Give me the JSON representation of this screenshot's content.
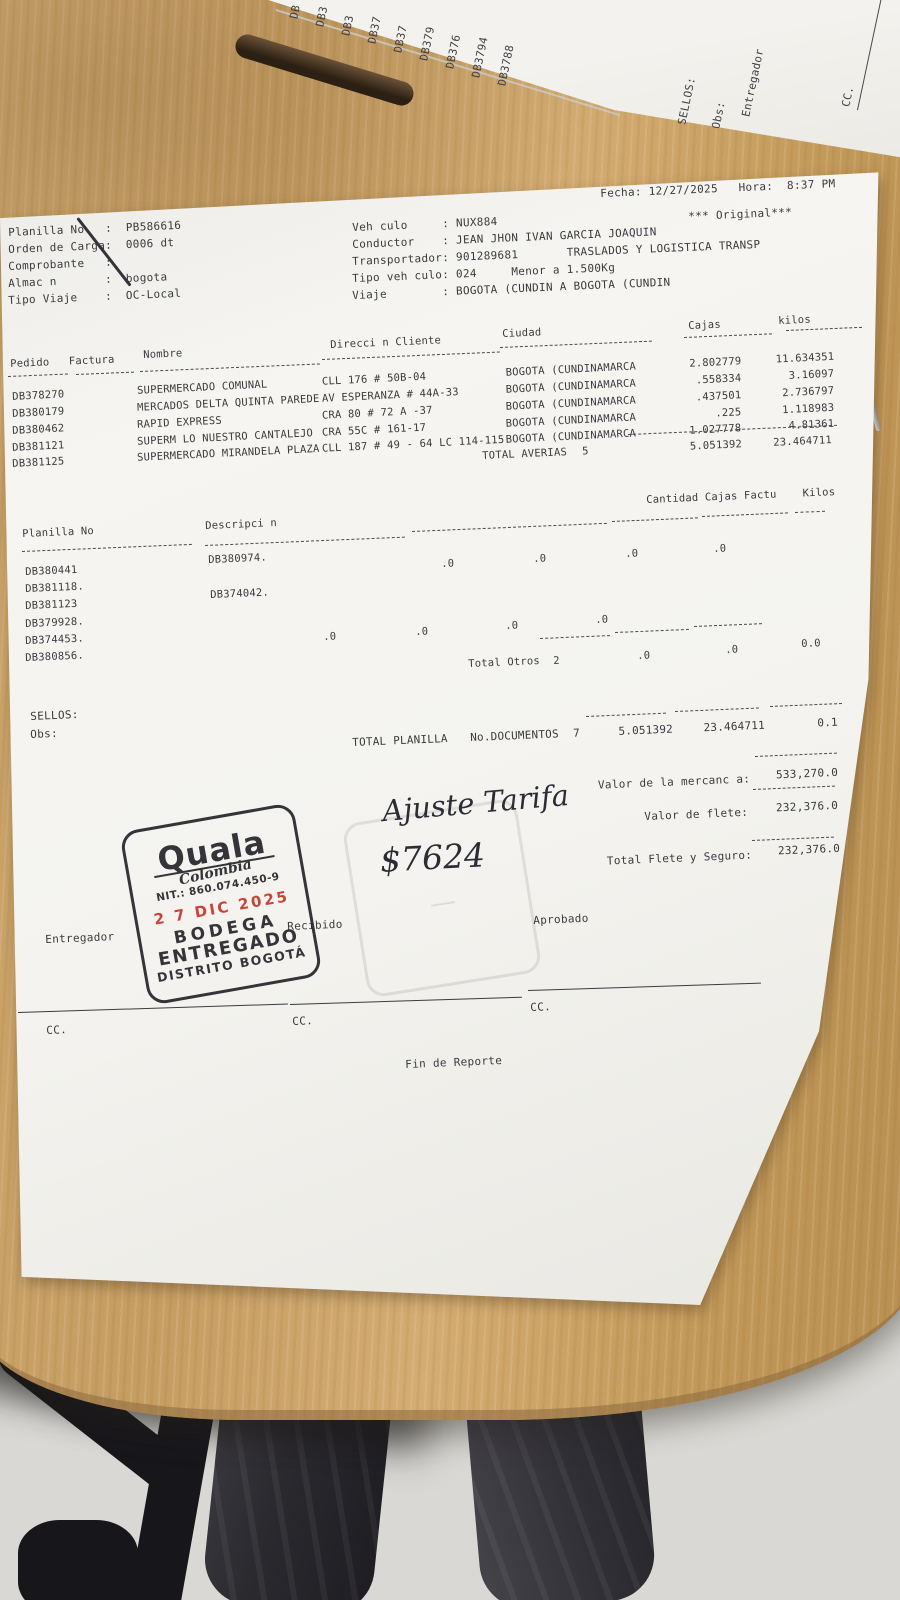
{
  "colors": {
    "paper": "#f4f3ef",
    "wood": "#c9a066",
    "floor": "#dadad6",
    "print_ink": "#3b3a3f",
    "stamp_ink": "#26262c",
    "stamp_date_red": "#c5372a"
  },
  "top_sheet": {
    "doc_ids": [
      "DB",
      "DB3",
      "DB3",
      "DB37",
      "DB37",
      "DB379",
      "DB376",
      "DB3794",
      "DB3788"
    ],
    "sellos": "SELLOS:",
    "obs": "Obs:",
    "entregador": "Entregador",
    "cc": "CC."
  },
  "doc": {
    "fecha_line": "Fecha: 12/27/2025   Hora:  8:37 PM",
    "original": "*** Original***",
    "info_left": [
      "Planilla No   :  PB586616",
      "Orden de Carga:  0006 dt",
      "Comprobante   :",
      "Almac n       :  bogota",
      "Tipo Viaje    :  OC-Local"
    ],
    "info_right": [
      "Veh culo     : NUX884",
      "Conductor    : JEAN JHON IVAN GARCIA JOAQUIN",
      "Transportador: 901289681       TRASLADOS Y LOGISTICA TRANSP",
      "Tipo veh culo: 024     Menor a 1.500Kg",
      "Viaje        : BOGOTA (CUNDIN A BOGOTA (CUNDIN"
    ],
    "t1": {
      "h_pedido_factura": "Pedido   Factura",
      "h_nombre": "Nombre",
      "h_direccion": "Direcci n Cliente",
      "h_ciudad": "Ciudad",
      "h_cajas": "Cajas",
      "h_kilos": "kilos",
      "rows": [
        {
          "pedido": "DB378270",
          "nombre": "SUPERMERCADO COMUNAL",
          "direccion": "CLL 176 # 50B-04",
          "ciudad": "BOGOTA (CUNDINAMARCA",
          "cajas": "2.802779",
          "kilos": "11.634351"
        },
        {
          "pedido": "DB380179",
          "nombre": "MERCADOS DELTA QUINTA PAREDE",
          "direccion": "AV ESPERANZA # 44A-33",
          "ciudad": "BOGOTA (CUNDINAMARCA",
          "cajas": ".558334",
          "kilos": "3.16097"
        },
        {
          "pedido": "DB380462",
          "nombre": "RAPID EXPRESS",
          "direccion": "CRA 80 # 72 A -37",
          "ciudad": "BOGOTA (CUNDINAMARCA",
          "cajas": ".437501",
          "kilos": "2.736797"
        },
        {
          "pedido": "DB381121",
          "nombre": "SUPERM LO NUESTRO CANTALEJO",
          "direccion": "CRA 55C # 161-17",
          "ciudad": "BOGOTA (CUNDINAMARCA",
          "cajas": ".225",
          "kilos": "1.118983"
        },
        {
          "pedido": "DB381125",
          "nombre": "SUPERMERCADO MIRANDELA PLAZA",
          "direccion": "CLL 187 # 49 - 64 LC 114-115",
          "ciudad": "BOGOTA (CUNDINAMARCA",
          "cajas": "1.027778",
          "kilos": "4.81361"
        }
      ],
      "total_label": "TOTAL AVERIAS",
      "total_count": "5",
      "total_cajas": "5.051392",
      "total_kilos": "23.464711"
    },
    "t2": {
      "h_planilla": "Planilla No",
      "h_desc": "Descripci n",
      "h_right": "Cantidad Cajas Factu    Kilos",
      "planillas": [
        "DB380441",
        "DB381118.",
        "DB381123",
        "DB379928.",
        "DB374453.",
        "DB380856."
      ],
      "desc1": "DB380974.",
      "desc2": "DB374042.",
      "r1": [
        ".0",
        ".0",
        ".0",
        ".0"
      ],
      "r2": [
        ".0",
        ".0",
        ".0",
        ".0"
      ],
      "total_label": "Total Otros",
      "total_count": "2",
      "tv1": ".0",
      "tv2": ".0",
      "tv3": "0.0"
    },
    "sellos": "SELLOS:",
    "obs": "Obs:",
    "tp": {
      "label": "TOTAL PLANILLA",
      "docs_label": "No.DOCUMENTOS",
      "docs": "7",
      "cajas": "5.051392",
      "kilos": "23.464711",
      "extra": "0.1"
    },
    "val": {
      "l1": "Valor de la mercanc a:",
      "v1": "533,270.0",
      "l2": "Valor de flete:",
      "v2": "232,376.0",
      "l3": "Total Flete y Seguro:",
      "v3": "232,376.0"
    },
    "hw1": "Ajuste Tarifa",
    "hw2": "$7624",
    "stamp": {
      "brand": "Quala",
      "country": "Colombia",
      "nit": "NIT.: 860.074.450-9",
      "date": "2 7 DIC 2025",
      "b1": "BODEGA",
      "b2": "ENTREGADO",
      "b3": "DISTRITO BOGOTÁ"
    },
    "sig": {
      "entregador": "Entregador",
      "recibido": "Recibido",
      "aprobado": "Aprobado",
      "cc": "CC."
    },
    "fin": "Fin de Reporte"
  }
}
